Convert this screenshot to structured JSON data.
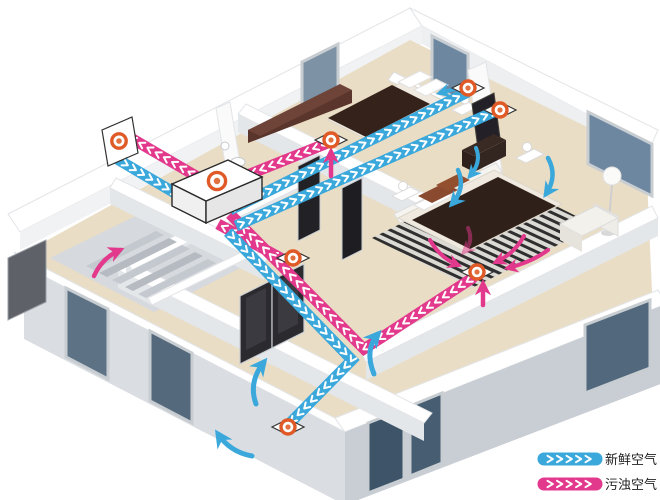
{
  "legend": {
    "items": [
      {
        "id": "fresh",
        "label": "新鲜空气"
      },
      {
        "id": "exhaust",
        "label": "污浊空气"
      }
    ]
  },
  "colors": {
    "fresh": "#3BA8DC",
    "exhaust": "#E2398C",
    "vent_ring": "#E05A28",
    "vent_dot": "#E2703E",
    "floor": "#EADDC5",
    "floor_grey": "#D6D9DD",
    "wall_top": "#FFFFFF",
    "wall_face": "#E4E7EA",
    "window_glass": "#6D87A0",
    "window_frame": "#C8CDD2",
    "duvet": "#35221A",
    "wood": "#6E4338",
    "door": "#2B2B2F",
    "text": "#222222"
  }
}
